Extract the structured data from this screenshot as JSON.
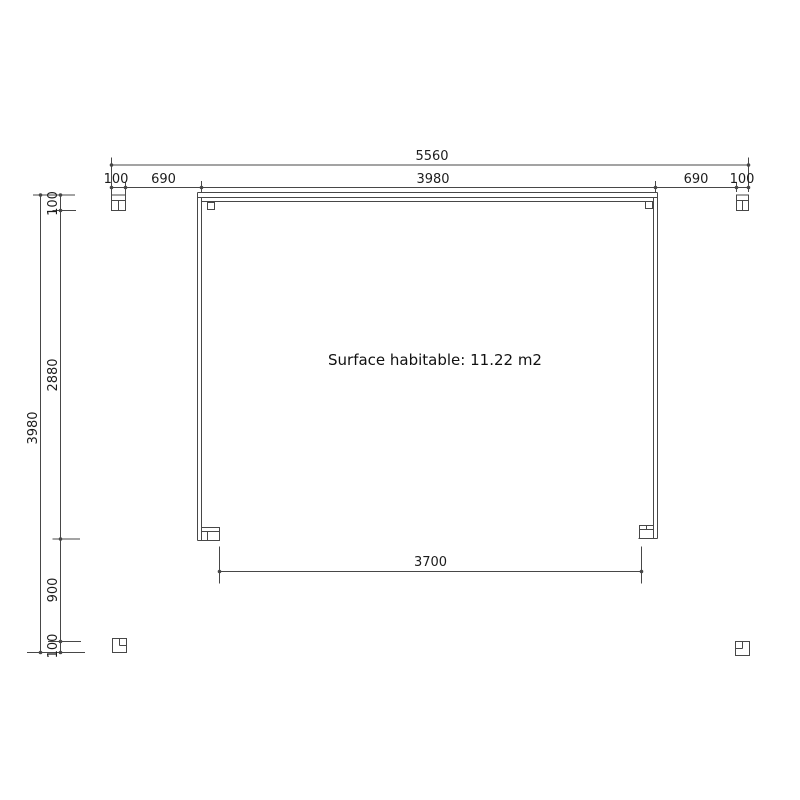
{
  "drawing": {
    "surface_label": "Surface habitable: 11.22 m2",
    "dimensions": {
      "top_overall": "5560",
      "top_segments": [
        "100",
        "690",
        "3980",
        "690",
        "100"
      ],
      "left_overall": "3980",
      "left_segments": [
        "100",
        "2880",
        "900",
        "100"
      ],
      "bottom_inner": "3700"
    },
    "colors": {
      "line": "#474747",
      "text": "#1c1c1c",
      "background": "#ffffff"
    }
  }
}
